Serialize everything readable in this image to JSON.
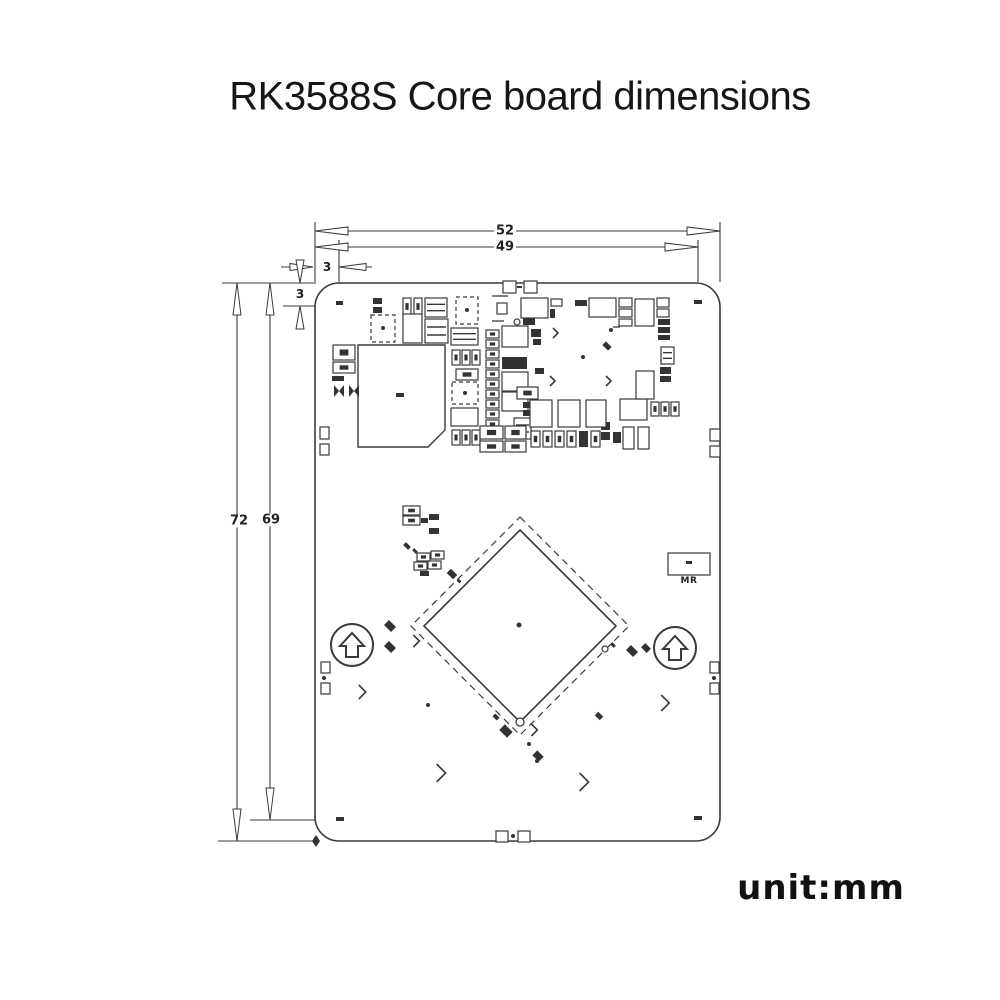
{
  "title": "RK3588S Core board dimensions",
  "unit_label": "unit:mm",
  "dimensions": {
    "width_total": "52",
    "width_inner": "49",
    "edge_offset_h": "3",
    "edge_offset_v": "3",
    "height_total": "72",
    "height_inner": "69"
  },
  "board": {
    "mr_label": "MR",
    "components_format": "each item: [type,x,y,a,b,(dir)] — r=outline-rect(w,h) f=filled-rect d=dashed-rect s=rect-with-inner-pad h=striped-rect o=rotated45-filled-rect(centered) b=bowtie p=dot(r) g=ring(r) l=line(x2,y2) c=chevron(size,dir u/d/l/r)",
    "components": [
      [
        "f",
        336,
        301,
        7,
        4
      ],
      [
        "f",
        694,
        300,
        8,
        4
      ],
      [
        "f",
        336,
        817,
        8,
        4
      ],
      [
        "f",
        694,
        816,
        8,
        4
      ],
      [
        "r",
        503,
        281,
        13,
        12
      ],
      [
        "r",
        524,
        281,
        13,
        12
      ],
      [
        "f",
        517,
        286,
        5,
        2
      ],
      [
        "r",
        496,
        831,
        12,
        11
      ],
      [
        "r",
        518,
        831,
        12,
        11
      ],
      [
        "p",
        513,
        836,
        2
      ],
      [
        "r",
        320,
        427,
        9,
        12
      ],
      [
        "r",
        320,
        444,
        9,
        11
      ],
      [
        "r",
        710,
        429,
        10,
        12
      ],
      [
        "r",
        710,
        446,
        10,
        11
      ],
      [
        "r",
        321,
        662,
        9,
        11
      ],
      [
        "p",
        324,
        678,
        2
      ],
      [
        "r",
        321,
        683,
        9,
        11
      ],
      [
        "r",
        710,
        662,
        9,
        11
      ],
      [
        "p",
        714,
        678,
        2
      ],
      [
        "r",
        710,
        683,
        9,
        11
      ],
      [
        "f",
        373,
        298,
        9,
        6
      ],
      [
        "f",
        373,
        307,
        9,
        6
      ],
      [
        "s",
        403,
        298,
        8,
        17
      ],
      [
        "s",
        414,
        298,
        8,
        17
      ],
      [
        "h",
        425,
        298,
        22,
        19
      ],
      [
        "d",
        456,
        297,
        22,
        27
      ],
      [
        "p",
        467,
        310,
        2
      ],
      [
        "l",
        492,
        296,
        508,
        296
      ],
      [
        "r",
        497,
        303,
        10,
        11
      ],
      [
        "r",
        521,
        298,
        27,
        20
      ],
      [
        "r",
        551,
        299,
        11,
        7
      ],
      [
        "f",
        550,
        309,
        5,
        9
      ],
      [
        "f",
        575,
        300,
        12,
        6
      ],
      [
        "r",
        589,
        298,
        27,
        19
      ],
      [
        "r",
        619,
        298,
        13,
        9
      ],
      [
        "r",
        619,
        309,
        13,
        8
      ],
      [
        "r",
        619,
        319,
        13,
        7
      ],
      [
        "r",
        635,
        299,
        19,
        27
      ],
      [
        "r",
        657,
        298,
        12,
        9
      ],
      [
        "r",
        657,
        309,
        12,
        8
      ],
      [
        "f",
        658,
        319,
        12,
        6
      ],
      [
        "f",
        658,
        327,
        12,
        6
      ],
      [
        "f",
        658,
        335,
        12,
        5
      ],
      [
        "d",
        371,
        315,
        24,
        27
      ],
      [
        "p",
        383,
        328,
        2
      ],
      [
        "r",
        403,
        314,
        19,
        29
      ],
      [
        "h",
        425,
        319,
        23,
        24
      ],
      [
        "h",
        451,
        328,
        27,
        17
      ],
      [
        "l",
        492,
        321,
        504,
        321
      ],
      [
        "g",
        517,
        322,
        3
      ],
      [
        "f",
        523,
        318,
        12,
        7
      ],
      [
        "f",
        531,
        329,
        10,
        8
      ],
      [
        "f",
        533,
        339,
        8,
        6
      ],
      [
        "r",
        502,
        326,
        26,
        21
      ],
      [
        "c",
        556,
        333,
        5,
        "l"
      ],
      [
        "p",
        611,
        330,
        2
      ],
      [
        "l",
        613,
        327,
        620,
        327
      ],
      [
        "o",
        607,
        346,
        8,
        5
      ],
      [
        "s",
        333,
        345,
        22,
        15
      ],
      [
        "s",
        333,
        362,
        22,
        11
      ],
      [
        "f",
        332,
        376,
        12,
        5
      ],
      [
        "b",
        334,
        385,
        10,
        12
      ],
      [
        "b",
        349,
        385,
        10,
        12
      ],
      [
        "f",
        396,
        393,
        8,
        4
      ],
      [
        "s",
        452,
        350,
        8,
        15
      ],
      [
        "s",
        462,
        350,
        8,
        15
      ],
      [
        "s",
        472,
        350,
        8,
        15
      ],
      [
        "s",
        456,
        369,
        22,
        11
      ],
      [
        "d",
        452,
        382,
        26,
        22
      ],
      [
        "p",
        465,
        393,
        2
      ],
      [
        "r",
        451,
        408,
        27,
        18
      ],
      [
        "s",
        452,
        430,
        8,
        15
      ],
      [
        "s",
        462,
        430,
        8,
        15
      ],
      [
        "s",
        472,
        430,
        8,
        15
      ],
      [
        "s",
        486,
        330,
        13,
        8
      ],
      [
        "s",
        486,
        340,
        13,
        8
      ],
      [
        "s",
        486,
        350,
        13,
        8
      ],
      [
        "s",
        486,
        360,
        13,
        8
      ],
      [
        "s",
        486,
        370,
        13,
        8
      ],
      [
        "s",
        486,
        380,
        13,
        8
      ],
      [
        "s",
        486,
        390,
        13,
        8
      ],
      [
        "s",
        486,
        400,
        13,
        8
      ],
      [
        "s",
        486,
        410,
        13,
        8
      ],
      [
        "s",
        486,
        420,
        13,
        8
      ],
      [
        "s",
        486,
        430,
        13,
        8
      ],
      [
        "f",
        502,
        357,
        25,
        12
      ],
      [
        "r",
        502,
        372,
        26,
        19
      ],
      [
        "r",
        502,
        392,
        26,
        19
      ],
      [
        "f",
        535,
        368,
        9,
        6
      ],
      [
        "s",
        517,
        387,
        21,
        12
      ],
      [
        "f",
        523,
        402,
        11,
        6
      ],
      [
        "f",
        523,
        410,
        11,
        6
      ],
      [
        "h",
        514,
        418,
        17,
        21
      ],
      [
        "s",
        480,
        426,
        23,
        13
      ],
      [
        "s",
        480,
        441,
        23,
        11
      ],
      [
        "s",
        505,
        426,
        21,
        13
      ],
      [
        "s",
        505,
        441,
        21,
        11
      ],
      [
        "s",
        531,
        431,
        9,
        16
      ],
      [
        "s",
        543,
        431,
        9,
        16
      ],
      [
        "s",
        555,
        431,
        9,
        16
      ],
      [
        "s",
        567,
        431,
        9,
        16
      ],
      [
        "f",
        579,
        431,
        9,
        16
      ],
      [
        "s",
        591,
        431,
        9,
        16
      ],
      [
        "f",
        601,
        422,
        9,
        8
      ],
      [
        "f",
        601,
        432,
        9,
        8
      ],
      [
        "f",
        613,
        432,
        8,
        11
      ],
      [
        "r",
        530,
        400,
        22,
        27
      ],
      [
        "r",
        558,
        400,
        22,
        27
      ],
      [
        "r",
        586,
        400,
        20,
        27
      ],
      [
        "r",
        620,
        399,
        27,
        21
      ],
      [
        "s",
        651,
        402,
        8,
        14
      ],
      [
        "s",
        661,
        402,
        8,
        14
      ],
      [
        "s",
        671,
        402,
        8,
        14
      ],
      [
        "r",
        623,
        427,
        11,
        22
      ],
      [
        "r",
        638,
        427,
        11,
        22
      ],
      [
        "r",
        636,
        371,
        18,
        28
      ],
      [
        "h",
        661,
        347,
        13,
        17
      ],
      [
        "f",
        660,
        367,
        11,
        7
      ],
      [
        "f",
        660,
        376,
        11,
        6
      ],
      [
        "c",
        553,
        381,
        5,
        "l"
      ],
      [
        "c",
        609,
        381,
        5,
        "r"
      ],
      [
        "p",
        583,
        357,
        2
      ],
      [
        "s",
        403,
        506,
        17,
        9
      ],
      [
        "s",
        403,
        516,
        17,
        9
      ],
      [
        "f",
        421,
        518,
        7,
        5
      ],
      [
        "f",
        429,
        514,
        10,
        6
      ],
      [
        "f",
        429,
        528,
        10,
        6
      ],
      [
        "o",
        407,
        546,
        7,
        4
      ],
      [
        "o",
        415,
        551,
        5,
        3
      ],
      [
        "s",
        417,
        553,
        13,
        8
      ],
      [
        "s",
        431,
        551,
        13,
        8
      ],
      [
        "s",
        414,
        562,
        13,
        8
      ],
      [
        "s",
        428,
        561,
        13,
        8
      ],
      [
        "f",
        420,
        571,
        9,
        5
      ],
      [
        "o",
        452,
        574,
        9,
        6
      ],
      [
        "o",
        459,
        581,
        4,
        3
      ],
      [
        "o",
        390,
        626,
        10,
        7
      ],
      [
        "o",
        390,
        647,
        10,
        7
      ],
      [
        "c",
        417,
        641,
        6,
        "u"
      ],
      [
        "c",
        363,
        692,
        7,
        "l"
      ],
      [
        "p",
        428,
        705,
        2
      ],
      [
        "g",
        605,
        649,
        3
      ],
      [
        "o",
        613,
        645,
        5,
        3
      ],
      [
        "o",
        632,
        651,
        10,
        7
      ],
      [
        "o",
        646,
        648,
        8,
        6
      ],
      [
        "c",
        666,
        703,
        8,
        "r"
      ],
      [
        "o",
        496,
        717,
        6,
        4
      ],
      [
        "o",
        506,
        731,
        11,
        8
      ],
      [
        "c",
        535,
        730,
        6,
        "l"
      ],
      [
        "p",
        529,
        744,
        2
      ],
      [
        "o",
        538,
        756,
        9,
        7
      ],
      [
        "o",
        599,
        716,
        7,
        5
      ],
      [
        "c",
        442,
        773,
        9,
        "d"
      ],
      [
        "c",
        585,
        782,
        9,
        "d"
      ],
      [
        "p",
        537,
        761,
        2
      ],
      [
        "r",
        668,
        553,
        42,
        22
      ],
      [
        "f",
        686,
        561,
        6,
        3
      ]
    ]
  },
  "colors": {
    "line": "#3a3a3a",
    "fill_dark": "#333333",
    "text": "#1a1a1a",
    "background": "#ffffff"
  }
}
